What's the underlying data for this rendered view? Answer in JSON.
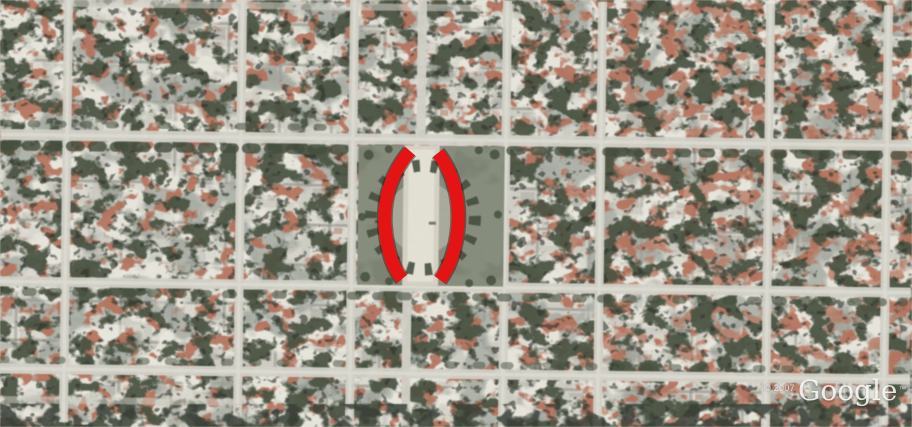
{
  "scene": {
    "type": "satellite-aerial-photo",
    "description": "Overhead satellite photo of a dense rectangular city grid: small blocks of white, cream and terracotta rooftops, dark tree-lined streets, and a central rectangular green plaza with a circular ring of trees around a light walkway.",
    "annotation": {
      "color": "#e41414",
      "outline_color": "#2a0f0a",
      "shape": "two thick hand-drawn red arc strokes forming an open parenthesis pair '( )' bracketing the central plaza walkway"
    },
    "park": {
      "feature": "rectangular plaza with circular tree ring and light central walkway",
      "micro_label": "illegible tiny label"
    },
    "palette": {
      "street": "#d6d3c8",
      "rooftop_white": "#f3f0e4",
      "rooftop_cream": "#e6e1d0",
      "rooftop_terracotta": "#c0705a",
      "vegetation": "#3d4834",
      "park_grass": "#868c78",
      "shadow": "#26291f",
      "plaza_walkway": "#ecead9"
    }
  },
  "watermark": {
    "copyright": "© 2007",
    "logo_text": "Google",
    "trademark": "™",
    "text_color": "#ffffff"
  }
}
